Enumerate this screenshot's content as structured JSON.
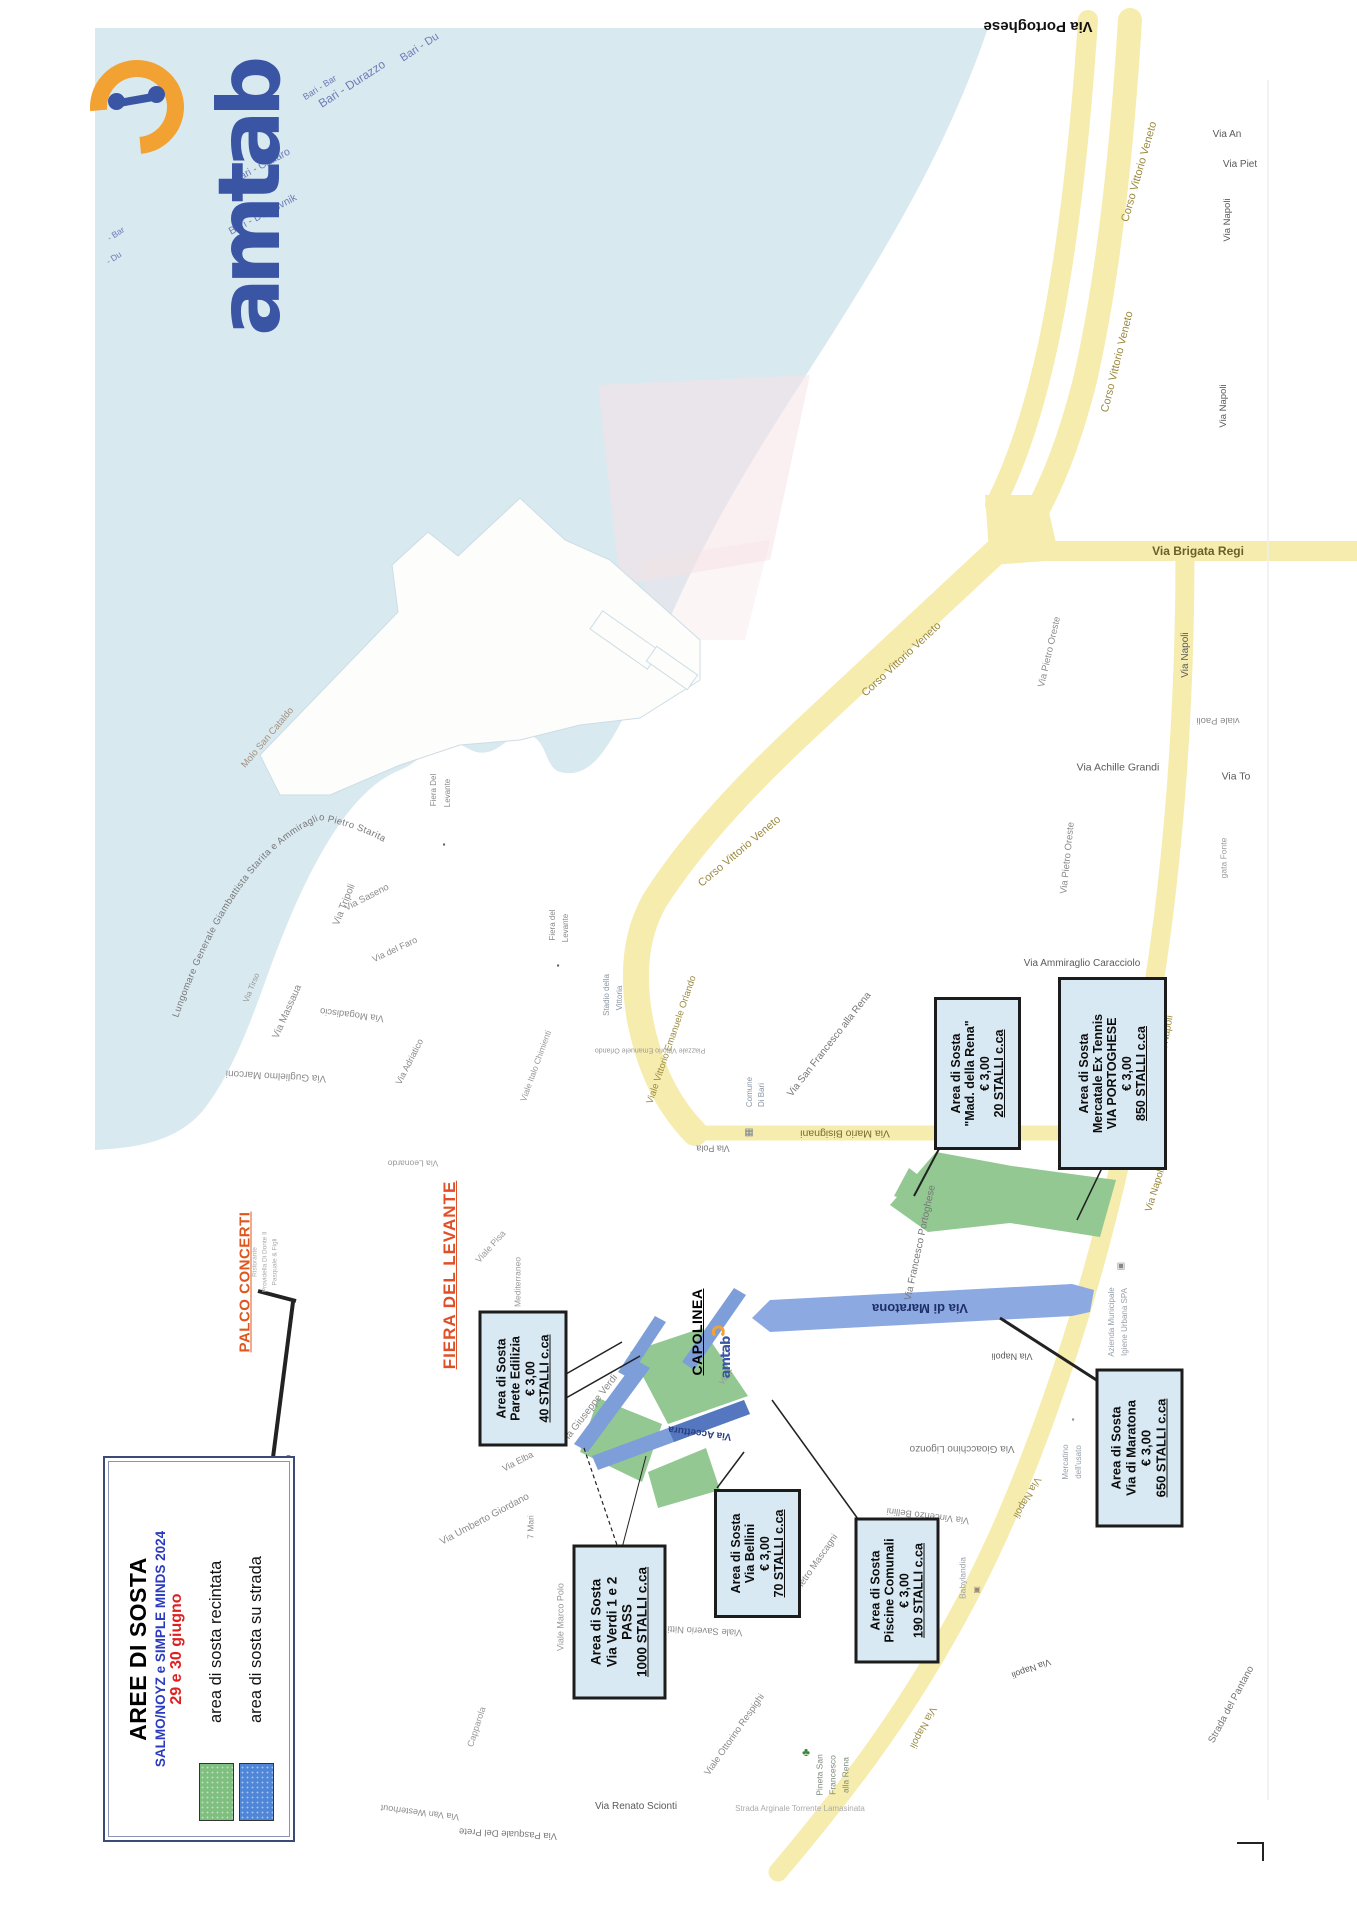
{
  "document": {
    "type": "scanned parking map leaflet",
    "city_features": "Port of Bari / Fiera del Levante area",
    "accent_colors": {
      "sea": "#d9e9f0",
      "road": "#f6ecae",
      "parking_green": "#93c892",
      "parking_blue": "#7d9ed9",
      "box_bg": "#d8e9f3",
      "palco_orange": "#e0561e",
      "legend_blue": "#2b3bbf",
      "legend_red": "#e02020",
      "logo_blue": "#3b55a5",
      "logo_orange": "#f2a233"
    }
  },
  "logo": {
    "text": "amtab"
  },
  "ferry_routes_note": "Bari ferry route labels printed on the sea",
  "legend": {
    "title": "AREE DI SOSTA",
    "subtitle": "SALMO/NOYZ e SIMPLE MINDS 2024",
    "date": "29 e 30 giugno",
    "items": [
      {
        "label": "area di sosta recintata",
        "color": "#7fbf7f"
      },
      {
        "label": "area di sosta su strada",
        "color": "#4f86d8"
      }
    ]
  },
  "palco": {
    "label": "PALCO CONCERTI"
  },
  "fiera": {
    "label": "FIERA DEL LEVANTE"
  },
  "capolinea": {
    "label": "CAPOLINEA",
    "logo": "amtab"
  },
  "streets": {
    "lungomare": "Lungomare Generale Giambattista Starita e Ammiraglio Pietro Starita"
  },
  "area_boxes": [
    {
      "id": "parete-edilizia",
      "cx": 523,
      "cy": 1378,
      "w": 83,
      "h": 130,
      "fs": 12.5,
      "lines": [
        "Area di Sosta",
        "Parete Edilizia",
        "€ 3,00",
        "40 STALLI c.ca"
      ]
    },
    {
      "id": "via-verdi",
      "cx": 619,
      "cy": 1622,
      "w": 88,
      "h": 149,
      "fs": 13.5,
      "lines": [
        "Area di Sosta",
        "Via Verdi 1 e 2",
        "PASS",
        "1000 STALLI c.ca"
      ]
    },
    {
      "id": "via-bellini",
      "cx": 757,
      "cy": 1553,
      "w": 81,
      "h": 123,
      "fs": 12.5,
      "lines": [
        "Area di Sosta",
        "Via Bellini",
        "€ 3,00",
        "70 STALLI c.ca"
      ]
    },
    {
      "id": "piscine-comunali",
      "cx": 897,
      "cy": 1590,
      "w": 79,
      "h": 140,
      "fs": 12.5,
      "lines": [
        "Area di Sosta",
        "Piscine Comunali",
        "€ 3,00",
        "190 STALLI c.ca"
      ]
    },
    {
      "id": "via-di-maratona",
      "cx": 1139,
      "cy": 1448,
      "w": 82,
      "h": 153,
      "fs": 13,
      "lines": [
        "Area di Sosta",
        "Via di Maratona",
        "€ 3,00",
        "650 STALLI c.ca"
      ]
    },
    {
      "id": "mad-della-rena",
      "cx": 977,
      "cy": 1073,
      "w": 81,
      "h": 147,
      "fs": 12.5,
      "lines": [
        "Area di Sosta",
        "\"Mad. della Rena\"",
        "€ 3,00",
        "20 STALLI c.ca"
      ]
    },
    {
      "id": "mercatale-ex-tennis",
      "cx": 1112,
      "cy": 1073,
      "w": 103,
      "h": 187,
      "fs": 12.5,
      "lines": [
        "Area di Sosta",
        "Mercatale Ex Tennis",
        "VIA PORTOGHESE",
        "€ 3,00",
        "850 STALLI c.ca"
      ]
    }
  ],
  "street_labels": [
    {
      "t": "Bari - Bar",
      "x": 320,
      "y": 88,
      "r": -33,
      "s": 9,
      "c": "#6d7cb5"
    },
    {
      "t": "Bari - Durazzo",
      "x": 352,
      "y": 84,
      "r": -33,
      "s": 12,
      "c": "#6d7cb5"
    },
    {
      "t": "Bari - Du",
      "x": 420,
      "y": 48,
      "r": -33,
      "s": 11,
      "c": "#6d7cb5"
    },
    {
      "t": "Bari - Cattaro",
      "x": 262,
      "y": 166,
      "r": -28,
      "s": 10.5,
      "c": "#6d7cb5"
    },
    {
      "t": "Bari - Dubrovnik",
      "x": 263,
      "y": 215,
      "r": -28,
      "s": 10.5,
      "c": "#6d7cb5"
    },
    {
      "t": "- Bar",
      "x": 116,
      "y": 234,
      "r": -33,
      "s": 8.5,
      "c": "#6d7cb5"
    },
    {
      "t": "- Du",
      "x": 114,
      "y": 258,
      "r": -33,
      "s": 8.5,
      "c": "#6d7cb5"
    },
    {
      "t": "Molo San Cataldo",
      "x": 268,
      "y": 738,
      "r": -50,
      "s": 9.5,
      "c": "#a5917f"
    },
    {
      "t": "Via Tripoli",
      "x": 345,
      "y": 905,
      "r": -68,
      "s": 10,
      "c": "#8a8a8a"
    },
    {
      "t": "Via Tirso",
      "x": 252,
      "y": 988,
      "r": -68,
      "s": 8,
      "c": "#9a9a9a"
    },
    {
      "t": "Via Saseno",
      "x": 367,
      "y": 898,
      "r": -27,
      "s": 9.5,
      "c": "#8a8a8a"
    },
    {
      "t": "Via del Faro",
      "x": 395,
      "y": 950,
      "r": -25,
      "s": 9,
      "c": "#8a8a8a"
    },
    {
      "t": "Via Massaua",
      "x": 288,
      "y": 1012,
      "r": -66,
      "s": 10,
      "c": "#8a8a8a"
    },
    {
      "t": "Via Mogadiscio",
      "x": 352,
      "y": 1014,
      "r": 187,
      "s": 9.5,
      "c": "#8a8a8a"
    },
    {
      "t": "Via Adriatico",
      "x": 410,
      "y": 1062,
      "r": -63,
      "s": 9,
      "c": "#8a8a8a"
    },
    {
      "t": "Via Guglielmo Marconi",
      "x": 276,
      "y": 1075,
      "r": 183,
      "s": 10,
      "c": "#8a8a8a"
    },
    {
      "t": "Fiera Del",
      "x": 434,
      "y": 790,
      "r": -90,
      "s": 8,
      "c": "#8a8a8a"
    },
    {
      "t": "Levante",
      "x": 448,
      "y": 793,
      "r": -90,
      "s": 8,
      "c": "#8a8a8a"
    },
    {
      "t": "▪",
      "x": 444,
      "y": 845,
      "r": 0,
      "s": 8,
      "c": "#555555"
    },
    {
      "t": "Fiera del",
      "x": 553,
      "y": 925,
      "r": -90,
      "s": 8,
      "c": "#8a8a8a"
    },
    {
      "t": "Levante",
      "x": 566,
      "y": 928,
      "r": -90,
      "s": 8,
      "c": "#8a8a8a"
    },
    {
      "t": "▪",
      "x": 558,
      "y": 966,
      "r": 0,
      "s": 8,
      "c": "#555555"
    },
    {
      "t": "Via Pietro Oreste",
      "x": 1050,
      "y": 652,
      "r": -77,
      "s": 9.5,
      "c": "#8a8a8a"
    },
    {
      "t": "Via Pietro Oreste",
      "x": 1068,
      "y": 858,
      "r": -84,
      "s": 9.5,
      "c": "#8a8a8a"
    },
    {
      "t": "Via Achille Grandi",
      "x": 1118,
      "y": 768,
      "r": 0,
      "s": 10.5,
      "c": "#5a5a5a"
    },
    {
      "t": "Via To",
      "x": 1236,
      "y": 777,
      "r": 0,
      "s": 10.5,
      "c": "#5a5a5a"
    },
    {
      "t": "viale Paoli",
      "x": 1218,
      "y": 720,
      "r": 180,
      "s": 9.5,
      "c": "#8a8a8a"
    },
    {
      "t": "gata Fonte",
      "x": 1224,
      "y": 858,
      "r": -90,
      "s": 8.5,
      "c": "#9a9a9a"
    },
    {
      "t": "Via An",
      "x": 1227,
      "y": 135,
      "r": 0,
      "s": 10,
      "c": "#5a5a5a"
    },
    {
      "t": "Via Piet",
      "x": 1240,
      "y": 165,
      "r": 0,
      "s": 10,
      "c": "#5a5a5a"
    },
    {
      "t": "Via Napoli",
      "x": 1228,
      "y": 220,
      "r": -90,
      "s": 9.5,
      "c": "#5a5a5a"
    },
    {
      "t": "Via Napoli",
      "x": 1224,
      "y": 406,
      "r": -90,
      "s": 9.5,
      "c": "#5a5a5a"
    },
    {
      "t": "Via Brigata Regi",
      "x": 1198,
      "y": 551,
      "r": 0,
      "s": 12,
      "c": "#6a5f28",
      "w": 600
    },
    {
      "t": "Via Portoghese",
      "x": 1038,
      "y": 26,
      "r": 180,
      "s": 15,
      "c": "#111111",
      "w": 700
    },
    {
      "t": "Corso Vittorio Veneto",
      "x": 1140,
      "y": 172,
      "r": -74,
      "s": 11,
      "c": "#9a8a40"
    },
    {
      "t": "Corso Vittorio Veneto",
      "x": 1118,
      "y": 362,
      "r": -76,
      "s": 11,
      "c": "#9a8a40"
    },
    {
      "t": "Corso Vittorio Veneto",
      "x": 902,
      "y": 660,
      "r": -43,
      "s": 11,
      "c": "#9a8a40"
    },
    {
      "t": "Corso Vittorio Veneto",
      "x": 740,
      "y": 852,
      "r": -40,
      "s": 11,
      "c": "#9a8a40"
    },
    {
      "t": "Via Napoli",
      "x": 1186,
      "y": 655,
      "r": -90,
      "s": 10,
      "c": "#5a5a5a"
    },
    {
      "t": "Via Napoli",
      "x": 1167,
      "y": 1038,
      "r": -80,
      "s": 10,
      "c": "#9a8a40"
    },
    {
      "t": "Via Napoli",
      "x": 1156,
      "y": 1190,
      "r": -73,
      "s": 10,
      "c": "#9a8a40"
    },
    {
      "t": "Via Napoli",
      "x": 1026,
      "y": 1497,
      "r": 120,
      "s": 10,
      "c": "#9a8a40"
    },
    {
      "t": "Via Napoli",
      "x": 922,
      "y": 1727,
      "r": 118,
      "s": 10,
      "c": "#9a8a40"
    },
    {
      "t": "Via Napoli",
      "x": 1031,
      "y": 1668,
      "r": 160,
      "s": 9,
      "c": "#5a5a5a"
    },
    {
      "t": "Via Napoli",
      "x": 1012,
      "y": 1356,
      "r": 180,
      "s": 9,
      "c": "#5a5a5a"
    },
    {
      "t": "Viale Vittorio Emanuele Orlando",
      "x": 672,
      "y": 1040,
      "r": -71,
      "s": 9.5,
      "c": "#9a8a40"
    },
    {
      "t": "Via Mario Bisignani",
      "x": 845,
      "y": 1133,
      "r": 180,
      "s": 10.5,
      "c": "#7a6a30"
    },
    {
      "t": "Via San Francesco alla Rena",
      "x": 830,
      "y": 1045,
      "r": -52,
      "s": 10,
      "c": "#777777"
    },
    {
      "t": "Via Ammiraglio Caracciolo",
      "x": 1082,
      "y": 964,
      "r": 0,
      "s": 10,
      "c": "#5a5a5a"
    },
    {
      "t": "Via Francesco Portoghese",
      "x": 921,
      "y": 1243,
      "r": -78,
      "s": 10,
      "c": "#777777"
    },
    {
      "t": "Comune",
      "x": 750,
      "y": 1092,
      "r": -90,
      "s": 8,
      "c": "#8a97a5"
    },
    {
      "t": "Di Bari",
      "x": 762,
      "y": 1095,
      "r": -90,
      "s": 8,
      "c": "#8a97a5"
    },
    {
      "t": "▦",
      "x": 749,
      "y": 1133,
      "r": 0,
      "s": 10,
      "c": "#7a8795"
    },
    {
      "t": "Stadio della",
      "x": 607,
      "y": 995,
      "r": -90,
      "s": 8,
      "c": "#8a97a5"
    },
    {
      "t": "Vittoria",
      "x": 620,
      "y": 998,
      "r": -90,
      "s": 8,
      "c": "#8a97a5"
    },
    {
      "t": "Piazzale Vittorio Emanuele Orlando",
      "x": 650,
      "y": 1050,
      "r": 180,
      "s": 7,
      "c": "#999999"
    },
    {
      "t": "Via Pola",
      "x": 713,
      "y": 1148,
      "r": 180,
      "s": 9,
      "c": "#777777"
    },
    {
      "t": "Via Leonardo",
      "x": 413,
      "y": 1163,
      "r": 180,
      "s": 8.5,
      "c": "#999999"
    },
    {
      "t": "Viale Italo Chimienti",
      "x": 536,
      "y": 1066,
      "r": -70,
      "s": 8.5,
      "c": "#999999"
    },
    {
      "t": "Viale Pisa",
      "x": 491,
      "y": 1247,
      "r": -48,
      "s": 9,
      "c": "#999999"
    },
    {
      "t": "Mediterraneo",
      "x": 518,
      "y": 1282,
      "r": -90,
      "s": 8.5,
      "c": "#999999"
    },
    {
      "t": "Ristorante",
      "x": 256,
      "y": 1262,
      "r": -90,
      "s": 6.5,
      "c": "#aaaaaa"
    },
    {
      "t": "Providella Di Donte Il",
      "x": 266,
      "y": 1262,
      "r": -90,
      "s": 6.5,
      "c": "#aaaaaa"
    },
    {
      "t": "Pasquale & Figli",
      "x": 276,
      "y": 1262,
      "r": -90,
      "s": 6.5,
      "c": "#aaaaaa"
    },
    {
      "t": "Via Paolo Pinto",
      "x": 289,
      "y": 1487,
      "r": -90,
      "s": 9.5,
      "c": "#777777"
    },
    {
      "t": "Via Umberto Giordano",
      "x": 485,
      "y": 1520,
      "r": -28,
      "s": 10,
      "c": "#8a8a8a"
    },
    {
      "t": "Via Elba",
      "x": 518,
      "y": 1462,
      "r": -27,
      "s": 9,
      "c": "#8a8a8a"
    },
    {
      "t": "7 Mari",
      "x": 531,
      "y": 1527,
      "r": -90,
      "s": 8.5,
      "c": "#8a8a8a"
    },
    {
      "t": "Viale Marco Polo",
      "x": 561,
      "y": 1617,
      "r": -90,
      "s": 9,
      "c": "#999999"
    },
    {
      "t": "Capparola",
      "x": 477,
      "y": 1727,
      "r": -72,
      "s": 9,
      "c": "#999999"
    },
    {
      "t": "Via Van Westerhout",
      "x": 420,
      "y": 1812,
      "r": 187,
      "s": 9,
      "c": "#8a8a8a"
    },
    {
      "t": "Via Pasquale Del Prete",
      "x": 508,
      "y": 1833,
      "r": 183,
      "s": 9.5,
      "c": "#777777"
    },
    {
      "t": "Via Renato Scionti",
      "x": 636,
      "y": 1807,
      "r": 0,
      "s": 10,
      "c": "#5a5a5a"
    },
    {
      "t": "Strada Arginale Torrente Lamasinata",
      "x": 800,
      "y": 1809,
      "r": 0,
      "s": 8,
      "c": "#aaaaaa"
    },
    {
      "t": "Viale Ottorino Respighi",
      "x": 735,
      "y": 1735,
      "r": -55,
      "s": 9.5,
      "c": "#8a8a8a"
    },
    {
      "t": "Viale Saverio Nitti",
      "x": 705,
      "y": 1630,
      "r": 183,
      "s": 9.5,
      "c": "#8a8a8a"
    },
    {
      "t": "Via Pietro Mascagni",
      "x": 812,
      "y": 1570,
      "r": -55,
      "s": 9.5,
      "c": "#8a8a8a"
    },
    {
      "t": "Pineta San",
      "x": 820,
      "y": 1775,
      "r": -90,
      "s": 8.5,
      "c": "#7a8a7a"
    },
    {
      "t": "Francesco",
      "x": 833,
      "y": 1775,
      "r": -90,
      "s": 8.5,
      "c": "#7a8a7a"
    },
    {
      "t": "alla Rena",
      "x": 846,
      "y": 1775,
      "r": -90,
      "s": 8.5,
      "c": "#7a8a7a"
    },
    {
      "t": "♣",
      "x": 806,
      "y": 1752,
      "r": 0,
      "s": 12,
      "c": "#3a8a3a"
    },
    {
      "t": "Babylandia",
      "x": 963,
      "y": 1578,
      "r": -90,
      "s": 8.5,
      "c": "#99a0aa"
    },
    {
      "t": "▣",
      "x": 977,
      "y": 1590,
      "r": 0,
      "s": 8,
      "c": "#998877"
    },
    {
      "t": "Via Vincenzo Bellini",
      "x": 928,
      "y": 1515,
      "r": 187,
      "s": 9.5,
      "c": "#8a8a8a"
    },
    {
      "t": "Via Gioacchino Ligonzo",
      "x": 962,
      "y": 1448,
      "r": 180,
      "s": 10,
      "c": "#777777"
    },
    {
      "t": "Mercatino",
      "x": 1066,
      "y": 1462,
      "r": -90,
      "s": 8,
      "c": "#99a0aa"
    },
    {
      "t": "dell'usato",
      "x": 1079,
      "y": 1462,
      "r": -90,
      "s": 8,
      "c": "#99a0aa"
    },
    {
      "t": "▪",
      "x": 1073,
      "y": 1420,
      "r": 0,
      "s": 8,
      "c": "#888888"
    },
    {
      "t": "Azienda Municipale",
      "x": 1112,
      "y": 1322,
      "r": -90,
      "s": 8,
      "c": "#99a0aa"
    },
    {
      "t": "Igiene Urbana SPA",
      "x": 1125,
      "y": 1322,
      "r": -90,
      "s": 8,
      "c": "#99a0aa"
    },
    {
      "t": "▣",
      "x": 1121,
      "y": 1266,
      "r": 0,
      "s": 9,
      "c": "#888888"
    },
    {
      "t": "Strada del Pantano",
      "x": 1232,
      "y": 1705,
      "r": -62,
      "s": 10,
      "c": "#777777"
    },
    {
      "t": "Via di Maratona",
      "x": 920,
      "y": 1308,
      "r": 180,
      "s": 13,
      "c": "#1e2e66",
      "w": 700
    },
    {
      "t": "Via Accettura",
      "x": 700,
      "y": 1432,
      "r": 187,
      "s": 10,
      "c": "#2a3f80",
      "w": 600
    },
    {
      "t": "Via Giuseppe Verdi",
      "x": 590,
      "y": 1410,
      "r": -52,
      "s": 10,
      "c": "#8a8a8a"
    },
    {
      "t": "Via F",
      "x": 727,
      "y": 1377,
      "r": -52,
      "s": 8,
      "c": "#999999"
    }
  ]
}
